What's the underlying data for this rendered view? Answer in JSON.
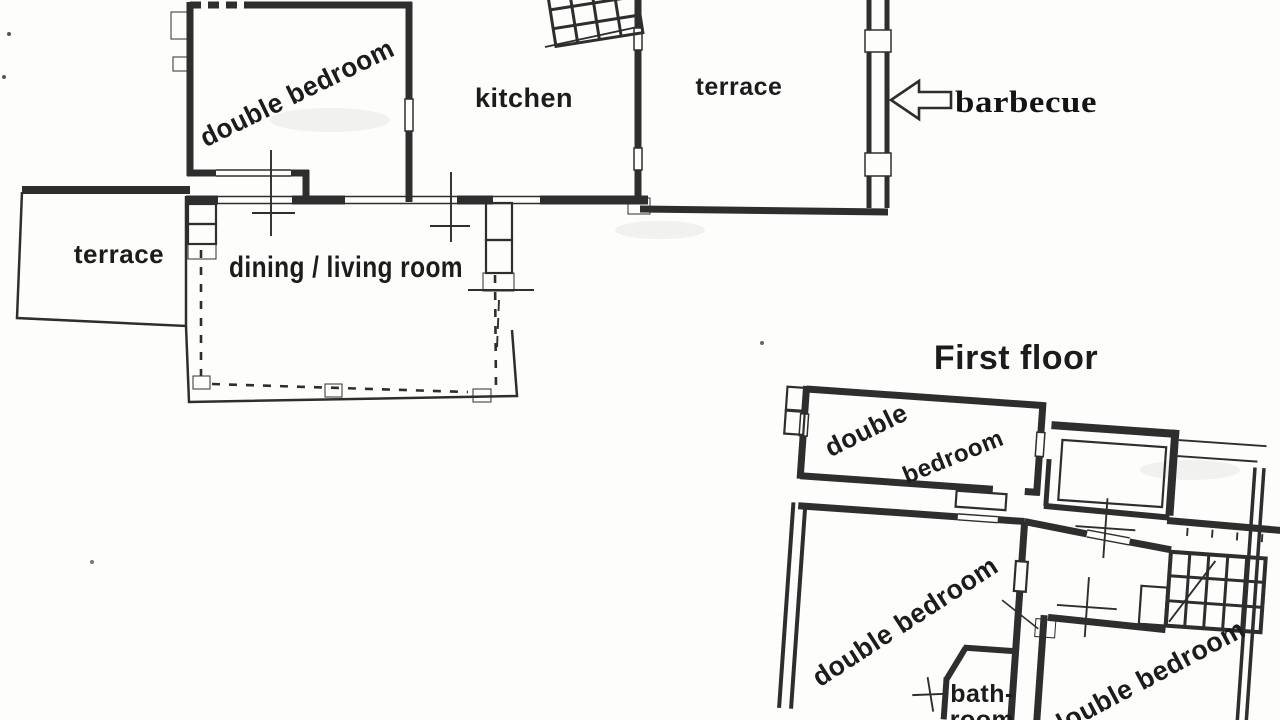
{
  "palette": {
    "ink": "#2e2e2e",
    "paper": "#fdfdfc",
    "label_color": "#1c1c1c"
  },
  "ground_floor": {
    "rooms": [
      {
        "id": "gf-double-bedroom",
        "label": "double bedroom"
      },
      {
        "id": "gf-kitchen",
        "label": "kitchen"
      },
      {
        "id": "gf-terrace-upper",
        "label": "terrace"
      },
      {
        "id": "gf-terrace-left",
        "label": "terrace"
      },
      {
        "id": "gf-dining-living",
        "label": "dining / living room"
      }
    ],
    "annotation": {
      "icon": "left-arrow-icon",
      "label": "barbecue"
    }
  },
  "first_floor": {
    "title": "First floor",
    "rooms": [
      {
        "id": "ff-double-bedroom-top",
        "label_line1": "double",
        "label_line2": "bedroom"
      },
      {
        "id": "ff-double-bedroom-left",
        "label": "double bedroom"
      },
      {
        "id": "ff-bathroom",
        "label_line1": "bath-",
        "label_line2": "room"
      },
      {
        "id": "ff-double-bedroom-right",
        "label": "double bedroom"
      }
    ]
  }
}
